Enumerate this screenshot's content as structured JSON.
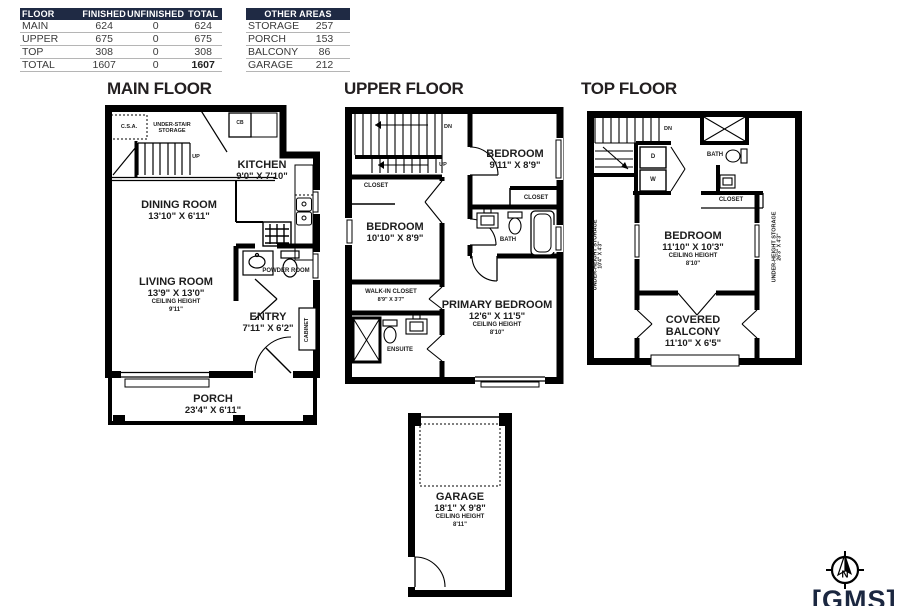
{
  "summary_table": {
    "headers": [
      "FLOOR",
      "FINISHED",
      "UNFINISHED",
      "TOTAL"
    ],
    "rows": [
      {
        "floor": "MAIN",
        "finished": "624",
        "unfinished": "0",
        "total": "624"
      },
      {
        "floor": "UPPER",
        "finished": "675",
        "unfinished": "0",
        "total": "675"
      },
      {
        "floor": "TOP",
        "finished": "308",
        "unfinished": "0",
        "total": "308"
      }
    ],
    "total_row": {
      "floor": "TOTAL",
      "finished": "1607",
      "unfinished": "0",
      "total": "1607"
    }
  },
  "other_areas": {
    "header": "OTHER AREAS",
    "rows": [
      {
        "label": "STORAGE",
        "value": "257"
      },
      {
        "label": "PORCH",
        "value": "153"
      },
      {
        "label": "BALCONY",
        "value": "86"
      },
      {
        "label": "GARAGE",
        "value": "212"
      }
    ]
  },
  "main_floor": {
    "title": "MAIN FLOOR",
    "csa": "C.S.A.",
    "understair_storage": "UNDER-STAIR STORAGE",
    "up": "UP",
    "cb": "CB",
    "kitchen_name": "KITCHEN",
    "kitchen_dims": "9'0\" X 7'10\"",
    "dining_name": "DINING ROOM",
    "dining_dims": "13'10\" X 6'11\"",
    "living_name": "LIVING ROOM",
    "living_dims": "13'9\" X 13'0\"",
    "living_ceiling_label": "CEILING HEIGHT",
    "living_ceiling": "9'11\"",
    "powder": "POWDER ROOM",
    "entry_name": "ENTRY",
    "entry_dims": "7'11\" X 6'2\"",
    "cabinet": "CABINET",
    "porch_name": "PORCH",
    "porch_dims": "23'4\" X 6'11\""
  },
  "upper_floor": {
    "title": "UPPER FLOOR",
    "dn": "DN",
    "up": "UP",
    "closet_left": "CLOSET",
    "bedroom1_name": "BEDROOM",
    "bedroom1_dims": "9'11\" X 8'9\"",
    "closet_right": "CLOSET",
    "bedroom2_name": "BEDROOM",
    "bedroom2_dims": "10'10\" X 8'9\"",
    "bath": "BATH",
    "walkin_name": "WALK-IN CLOSET",
    "walkin_dims": "8'9\" X 3'7\"",
    "ensuite": "ENSUITE",
    "primary_name": "PRIMARY BEDROOM",
    "primary_dims": "12'6\" X 11'5\"",
    "primary_ceiling_label": "CEILING HEIGHT",
    "primary_ceiling": "8'10\""
  },
  "top_floor": {
    "title": "TOP FLOOR",
    "dn": "DN",
    "dryer": "D",
    "washer": "W",
    "bath": "BATH",
    "closet": "CLOSET",
    "bedroom_name": "BEDROOM",
    "bedroom_dims": "11'10\" X 10'3\"",
    "bedroom_ceiling_label": "CEILING HEIGHT",
    "bedroom_ceiling": "8'10\"",
    "storage_left_name": "UNDER-HEIGHT STORAGE",
    "storage_left_dims": "10'4\" X 4'3\"",
    "storage_right_name": "UNDER-HEIGHT STORAGE",
    "storage_right_dims": "26'3\" X 4'3\"",
    "balcony_name": "COVERED BALCONY",
    "balcony_dims": "11'10\" X 6'5\""
  },
  "garage": {
    "name": "GARAGE",
    "dims": "18'1\" X 9'8\"",
    "ceiling_label": "CEILING HEIGHT",
    "ceiling": "8'11\""
  },
  "compass": {
    "label": "N"
  },
  "logo": {
    "text": "[GMS]"
  },
  "colors": {
    "wall": "#000000",
    "navy": "#1f2a44",
    "text": "#2e2e2e"
  }
}
